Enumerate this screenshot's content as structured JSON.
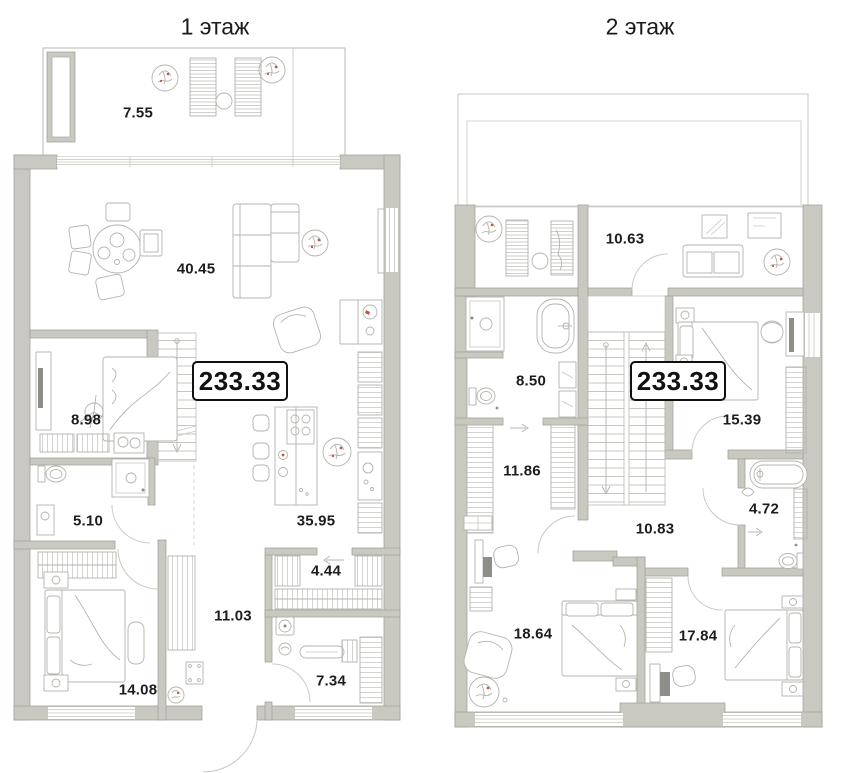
{
  "floors": [
    {
      "title": "1 этаж",
      "total_area": "233.33",
      "rooms": [
        {
          "name": "terrace",
          "area": "7.55"
        },
        {
          "name": "living-room",
          "area": "40.45"
        },
        {
          "name": "study",
          "area": "8.98"
        },
        {
          "name": "shower-room",
          "area": "5.10"
        },
        {
          "name": "kitchen",
          "area": "35.95"
        },
        {
          "name": "walk-in-closet",
          "area": "4.44"
        },
        {
          "name": "hallway",
          "area": "11.03"
        },
        {
          "name": "bedroom",
          "area": "14.08"
        },
        {
          "name": "laundry",
          "area": "7.34"
        }
      ]
    },
    {
      "title": "2 этаж",
      "total_area": "233.33",
      "rooms": [
        {
          "name": "lounge",
          "area": "10.63"
        },
        {
          "name": "bathroom",
          "area": "8.50"
        },
        {
          "name": "dressing-room",
          "area": "11.86"
        },
        {
          "name": "bedroom-1",
          "area": "15.39"
        },
        {
          "name": "hall",
          "area": "10.83"
        },
        {
          "name": "bathroom-2",
          "area": "4.72"
        },
        {
          "name": "bedroom-2",
          "area": "18.64"
        },
        {
          "name": "bedroom-3",
          "area": "17.84"
        }
      ]
    }
  ],
  "colors": {
    "wall": "#c9c9c1",
    "wall_edge": "#a3a39b",
    "furniture_line": "#b3b3ad",
    "accent_red": "#c0574c",
    "text": "#1d1d1d"
  }
}
